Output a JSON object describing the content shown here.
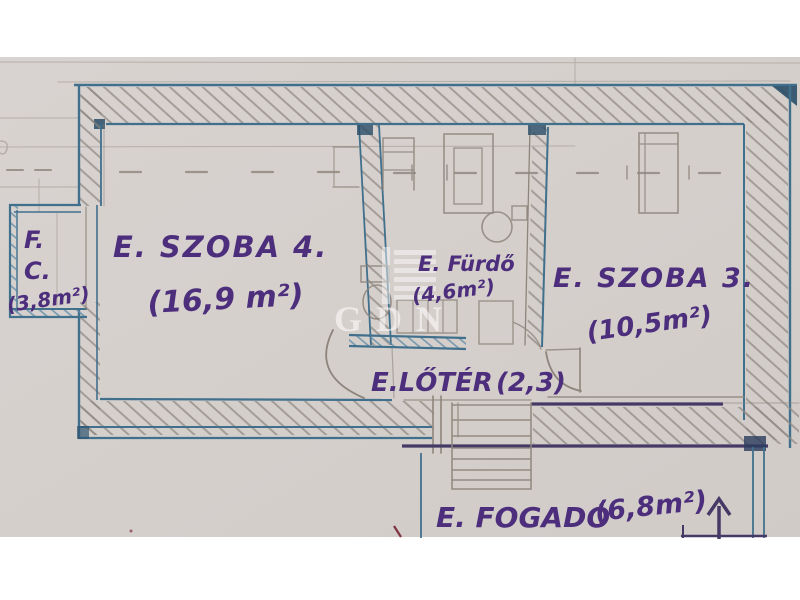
{
  "plan": {
    "title": "hand-drawn apartment floor plan (photo)",
    "watermark": {
      "logo_text": "GDN"
    },
    "rooms": {
      "fc": {
        "abbr_line1": "F.",
        "abbr_line2": "C.",
        "area": "(3,8m²)"
      },
      "szoba4": {
        "label": "E. SZOBA 4.",
        "area": "(16,9 m²)"
      },
      "furdo": {
        "label": "E. Fürdő",
        "area": "(4,6m²)"
      },
      "szoba3": {
        "label": "E. SZOBA 3.",
        "area": "(10,5m²)"
      },
      "eloter": {
        "label": "E.LŐTÉR",
        "area": "(2,3)"
      },
      "fogado": {
        "label": "E. FOGADÓ",
        "area": "(6,8m²)"
      }
    },
    "colors": {
      "paper": "#d5cfcc",
      "ink_blue": "#41708d",
      "ink_blue_dark": "#2a4e69",
      "ink_purple": "#4c2e7c",
      "ink_purple_dark": "#453a66",
      "pencil": "#8d857b",
      "red_mark": "#7e3340",
      "watermark": "#ffffff"
    }
  }
}
